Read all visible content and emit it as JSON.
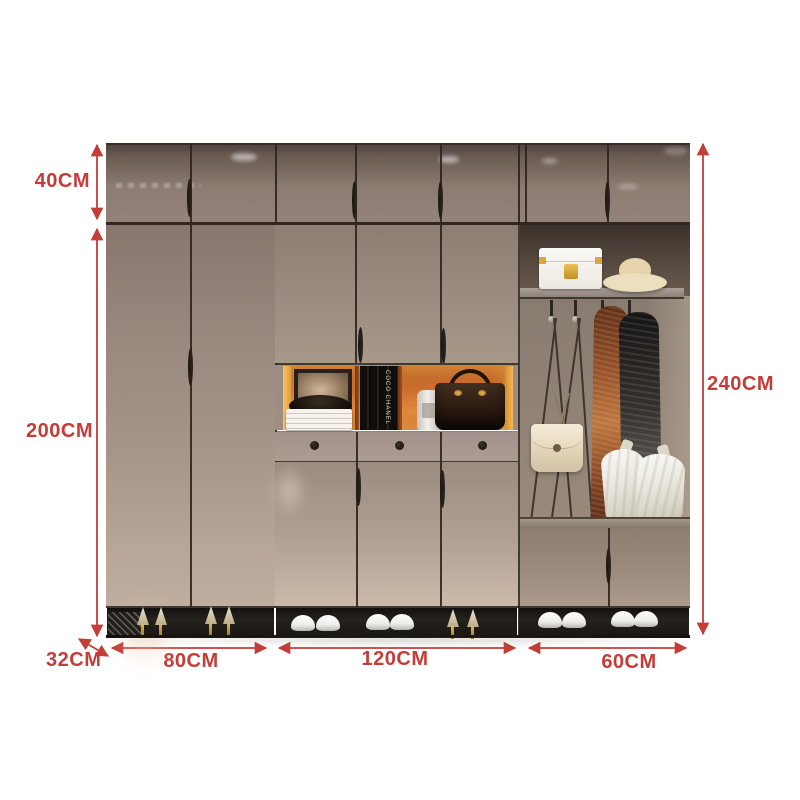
{
  "dimension_labels": {
    "top_section_height": "40CM",
    "main_section_height": "200CM",
    "total_height": "240CM",
    "depth": "32CM",
    "left_section_width": "80CM",
    "middle_section_width": "120CM",
    "right_section_width": "60CM"
  },
  "decor": {
    "book_spine_text": "COCO CHANEL"
  },
  "colors": {
    "annotation_red": "#c43d38",
    "door_taupe": "#a09084",
    "door_dark_top": "#5a4d45",
    "niche_orange": "#cf7030",
    "niche_glow_yellow": "#f4bd5c",
    "open_bay_interior": "#8c8076",
    "shoe_bay_black": "#1d1a17",
    "background_white": "#ffffff"
  }
}
